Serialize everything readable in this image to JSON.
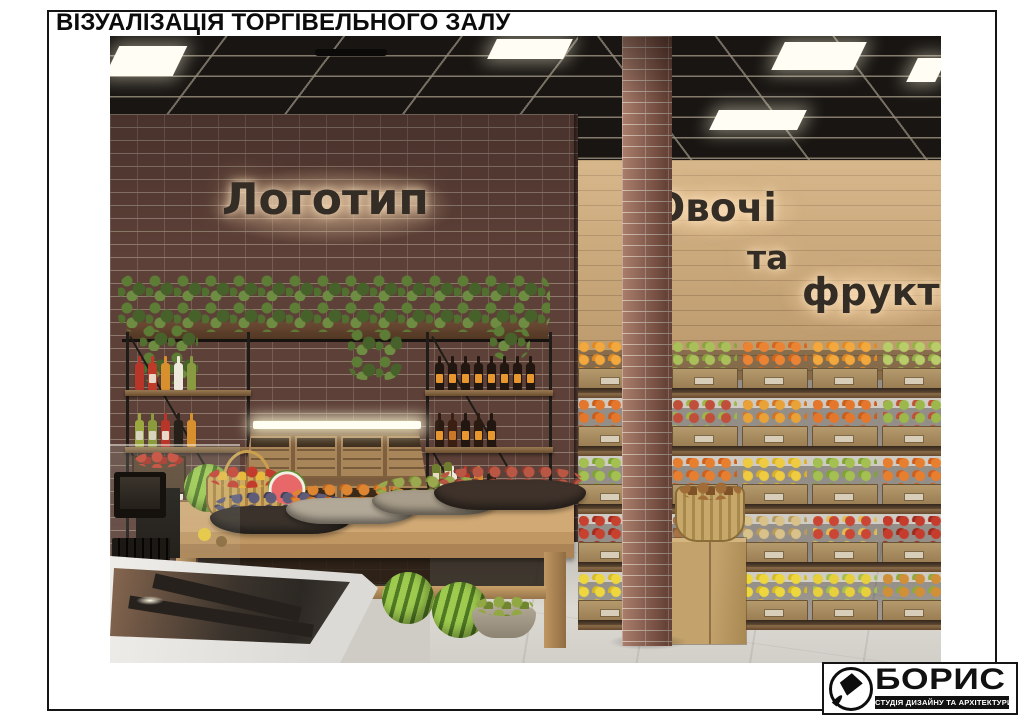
{
  "page": {
    "title": "ВІЗУАЛІЗАЦІЯ ТОРГІВЕЛЬНОГО ЗАЛУ"
  },
  "logo": {
    "name": "БОРИС",
    "tagline": "СТУДІЯ ДИЗАЙНУ ТА АРХІТЕКТУРИ",
    "icon": "paintbrush-icon"
  },
  "scene": {
    "signs": {
      "left_wall": "Логотип",
      "right_wall_line1": "Овочі",
      "right_wall_line2": "та",
      "right_wall_line3": "фрукти"
    },
    "palette": {
      "brick_wall": "#5d4038",
      "brick_column": "#935f4e",
      "wood_wall": "#c9a473",
      "ceiling": "#181512",
      "ceiling_grid": "#968c7c",
      "light_panel": "#fffdf4",
      "floor": "#d2cfc9",
      "table_wood": "#c9a16c",
      "sign_letters": "#332d26",
      "sign_glow": "#ffdeb4",
      "plant_green": "#5d7c35",
      "metal_frame": "#201c18"
    },
    "produce_rows": [
      [
        [
          "#f2a83c",
          "#e18a24"
        ],
        [
          "#a9c05a",
          "#8ba33e"
        ],
        [
          "#ea8434",
          "#d3661c"
        ],
        [
          "#f2a83c",
          "#e18a24"
        ],
        [
          "#b9cc6a",
          "#97b048"
        ]
      ],
      [
        [
          "#e4772b",
          "#c95e1c"
        ],
        [
          "#bf4f3a",
          "#9cb84a"
        ],
        [
          "#e8a238",
          "#d07428"
        ],
        [
          "#e4772b",
          "#c95e1c"
        ],
        [
          "#9cb84a",
          "#c24f38"
        ]
      ],
      [
        [
          "#a4c050",
          "#7fa436"
        ],
        [
          "#e87f2e",
          "#cf5f1f"
        ],
        [
          "#eecb40",
          "#dab02c"
        ],
        [
          "#a4c050",
          "#7fa436"
        ],
        [
          "#e87f2e",
          "#cf5f1f"
        ]
      ],
      [
        [
          "#c8402e",
          "#a32c1f"
        ],
        [
          "#a87246",
          "#845430"
        ],
        [
          "#d9c18a",
          "#b89a5c"
        ],
        [
          "#ca4534",
          "#e0bd54"
        ],
        [
          "#c63c2c",
          "#9e2b1e"
        ]
      ],
      [
        [
          "#eed63e",
          "#d6ba26"
        ],
        [
          "#c08a4c",
          "#9a6830"
        ],
        [
          "#eed63e",
          "#d6ba26"
        ],
        [
          "#e8cf3c",
          "#a4c050"
        ],
        [
          "#d19038",
          "#90a83c"
        ]
      ]
    ],
    "bottle_rows_left": [
      [
        [
          "#b8352a",
          null
        ],
        [
          "#c03a2a",
          "#e8d8c8"
        ],
        [
          "#d88f2e",
          null
        ],
        [
          "#efe9dc",
          null
        ],
        [
          "#8a9a40",
          null
        ]
      ],
      [
        [
          "#9aa83f",
          "#d8d2c0"
        ],
        [
          "#8a9a3c",
          "#d8d2c0"
        ],
        [
          "#b8352a",
          "#e8d8c8"
        ],
        [
          "#262018",
          null
        ],
        [
          "#d88f2e",
          null
        ]
      ],
      [
        [
          "#9aa83f",
          "#c8d0a0"
        ],
        [
          "#d88f2e",
          null
        ],
        [
          "#b8352a",
          null
        ],
        [
          "#efe9dc",
          "#b8352a"
        ]
      ]
    ],
    "bottle_rows_right": [
      [
        [
          "#221710",
          "#e8962e"
        ],
        [
          "#221710",
          "#e8962e"
        ],
        [
          "#221710",
          "#e8962e"
        ],
        [
          "#221710",
          "#e8962e"
        ],
        [
          "#221710",
          "#e8962e"
        ],
        [
          "#221710",
          "#e8962e"
        ],
        [
          "#221710",
          "#e8962e"
        ],
        [
          "#221710",
          "#e8962e"
        ]
      ],
      [
        [
          "#2a1a10",
          "#e8962e"
        ],
        [
          "#3a1f12",
          "#c87828"
        ],
        [
          "#221710",
          "#e8962e"
        ],
        [
          "#2a1a10",
          "#e8962e"
        ],
        [
          "#221710",
          "#e8962e"
        ]
      ],
      [
        [
          "#8a9a40",
          "#d8d2c0"
        ],
        [
          "#efe9dc",
          null
        ],
        [
          "#b8352a",
          "#e8d8c8"
        ],
        [
          "#d88f2e",
          null
        ],
        [
          "#262018",
          null
        ]
      ]
    ],
    "table_bowls": [
      {
        "bowl": "#3a322b",
        "f1": "#5f5c7a",
        "f2": "#433f58"
      },
      {
        "bowl": "#b3a998",
        "f1": "#de8531",
        "f2": "#c2661e"
      },
      {
        "bowl": "#a89d8a",
        "f1": "#9aa84e",
        "f2": "#7a9038"
      },
      {
        "bowl": "#3e322a",
        "f1": "#b95744",
        "f2": "#8c3a2e"
      }
    ]
  }
}
